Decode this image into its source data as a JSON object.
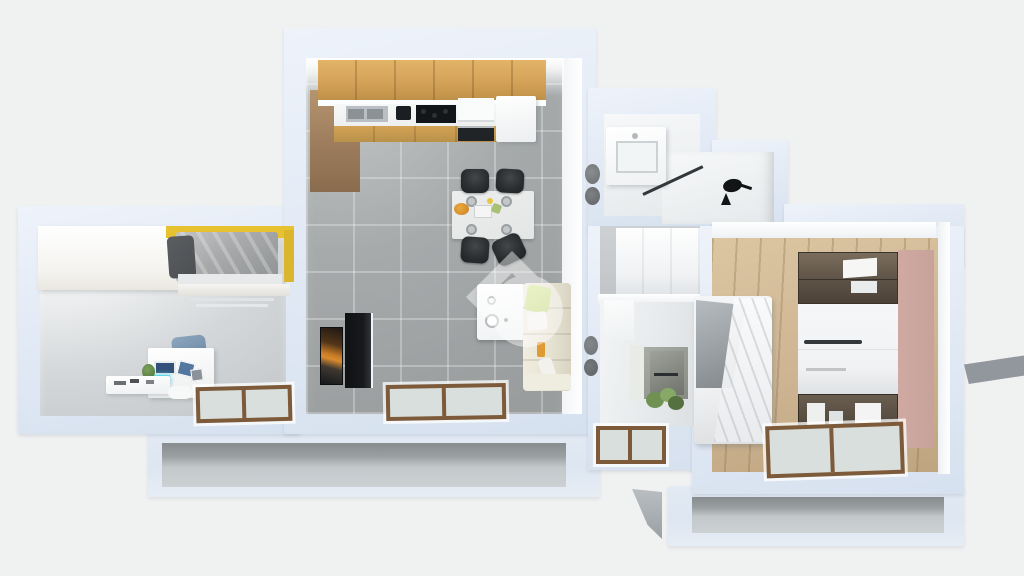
{
  "scene": {
    "type": "3d-floorplan-render",
    "description": "Axonometric dollhouse cutaway render of an apartment floor plan"
  },
  "colors": {
    "bg": "#f0f1f1",
    "wallLight": "#e4ebf6",
    "wallDark": "#d6e1ef",
    "wallFace": "#ffffff",
    "floorGray": "#d4d7d9",
    "floorTile": "#a6aaab",
    "floorWood": "#cdb492",
    "oak": "#d2a157",
    "woodPanel": "#9a7a5a",
    "counter": "#f4f5f5",
    "hob": "#131619",
    "table": "#eceeee",
    "chair": "#2a2d2f",
    "sofa": "#e7e3d2",
    "lime": "#c3d87e",
    "boiler": "#f8f9f9",
    "posterOrange": "#d98a2e",
    "media": "#17191c",
    "bedYellow": "#e6c230",
    "duvet": "#a7a9aa",
    "pillowDark": "#4c5053",
    "drape": "#eff0f1",
    "blanket": "#9da2a6",
    "smokedGlass": "#5d5246",
    "drawer": "#f1f2f3",
    "pink": "#c7a29b",
    "frame": "#7d5b3a",
    "glass": "#d9dfdc",
    "foundShadow": "#9aa0a2",
    "foundSlab": "#ccd1d4",
    "wedge": "#969ba0",
    "watermark": "#ffffff"
  },
  "watermark": {
    "label": "property-portal-watermark",
    "shape": "rotated-square-outline-with-circle",
    "opacity": "0.45"
  },
  "rooms": [
    {
      "label": "bedroom-left",
      "floor": "light-gray",
      "furniture": [
        "white-wardrobe",
        "single-bed-yellow-frame",
        "desk-with-laptop-and-hutch",
        "desk-chair",
        "floor-window"
      ]
    },
    {
      "label": "kitchen-living-room",
      "floor": "gray-tiles",
      "furniture": [
        "oak-wall-cabinets",
        "oak-tall-panel",
        "countertop-with-sink-hob-oven",
        "white-fridge-cabinet",
        "dining-table",
        "dining-chairs",
        "tv-art-screen",
        "black-media-cabinet",
        "wall-boiler",
        "cream-sofa",
        "floor-window"
      ]
    },
    {
      "label": "bathroom-top",
      "floor": "white",
      "furniture": [
        "vanity-sink",
        "toilet",
        "bidet",
        "glass-shower-screen"
      ]
    },
    {
      "label": "hallway",
      "floor": "white",
      "furniture": [
        "coat-stand"
      ]
    },
    {
      "label": "corridor",
      "floor": "gray",
      "furniture": [
        "white-wardrobe"
      ]
    },
    {
      "label": "bathroom-bottom",
      "floor": "light",
      "furniture": [
        "toilet",
        "bidet",
        "washer-mirror-column",
        "plant",
        "floor-window"
      ]
    },
    {
      "label": "bedroom-right",
      "floor": "oak-planks",
      "furniture": [
        "double-bed-white-drape",
        "wardrobe-smoked-glass-white-drawers",
        "pink-side-panel",
        "floor-window"
      ]
    }
  ]
}
